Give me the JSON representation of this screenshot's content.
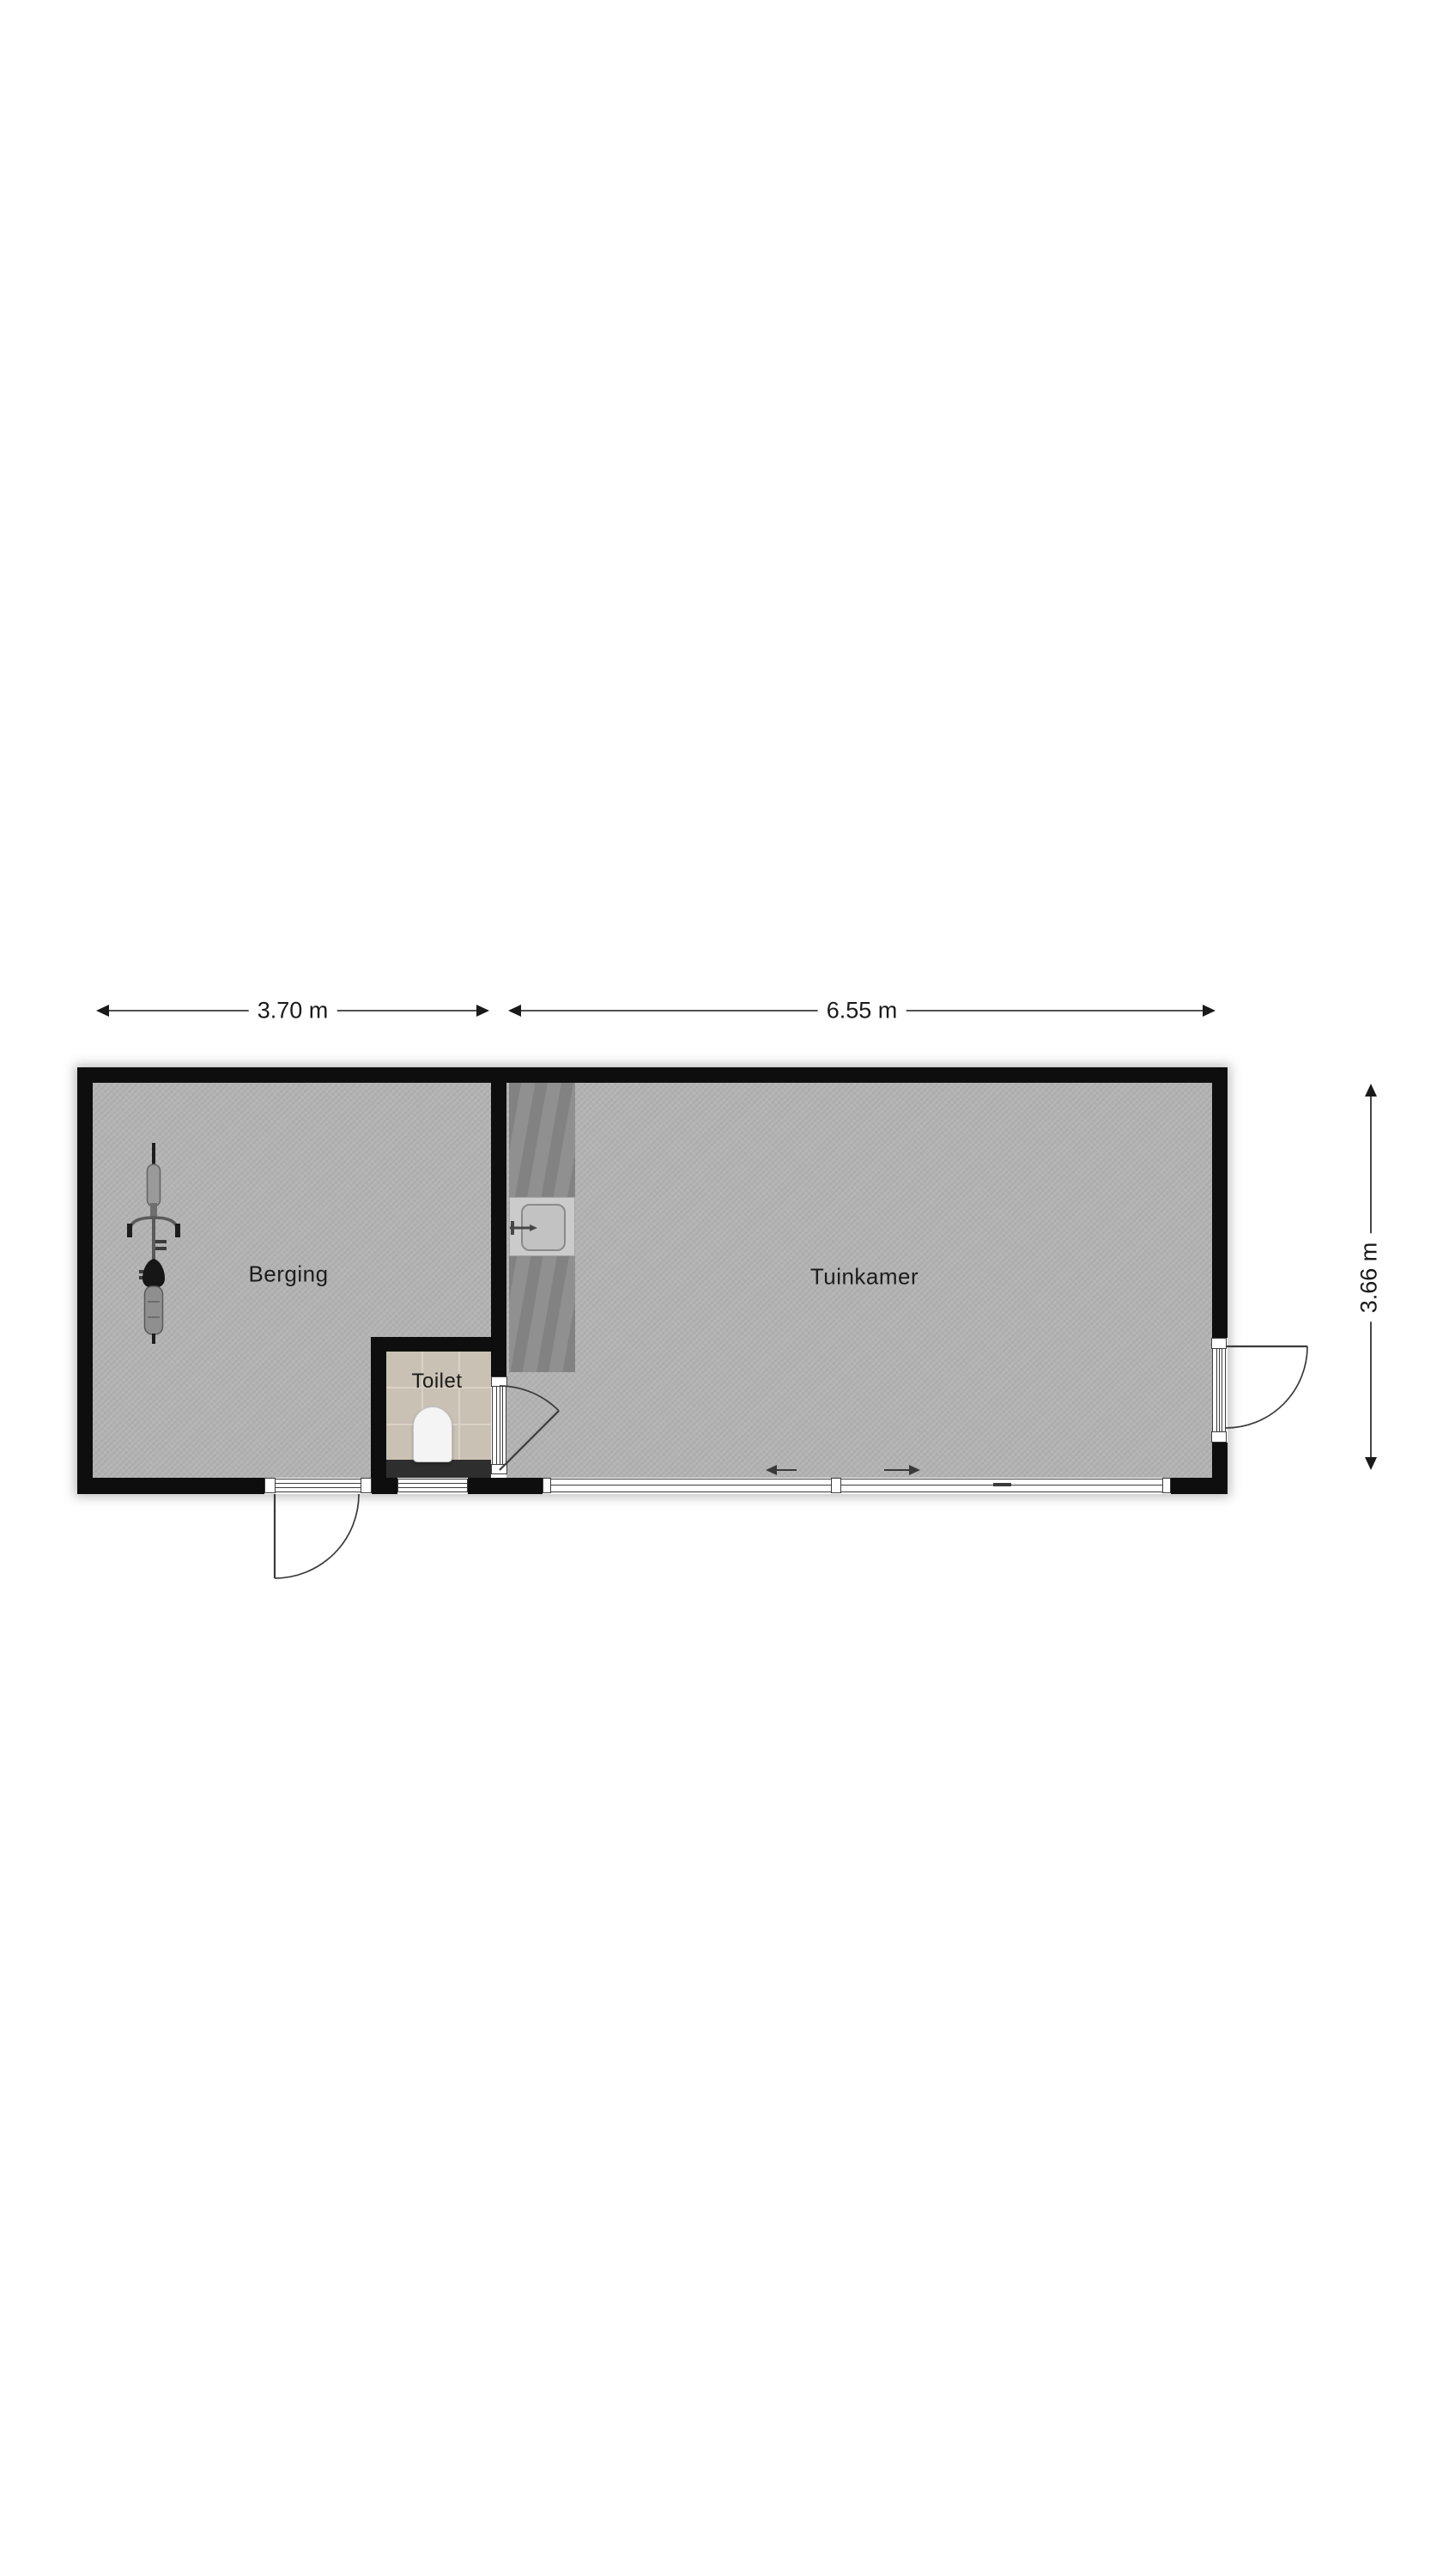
{
  "floorplan": {
    "type": "floor-plan",
    "rooms": [
      {
        "name": "Berging"
      },
      {
        "name": "Tuinkamer"
      },
      {
        "name": "Toilet"
      }
    ],
    "dimensions": {
      "berging_width": "3.70 m",
      "tuinkamer_width": "6.55 m",
      "depth": "3.66 m"
    },
    "fixtures": [
      {
        "icon": "bicycle-icon",
        "room": "Berging"
      },
      {
        "icon": "kitchen-counter",
        "room": "Tuinkamer"
      },
      {
        "icon": "kitchen-sink-icon",
        "room": "Tuinkamer"
      },
      {
        "icon": "faucet-icon",
        "room": "Tuinkamer"
      },
      {
        "icon": "toilet-fixture-icon",
        "room": "Toilet"
      },
      {
        "icon": "door-swing-icon",
        "count": 3
      },
      {
        "icon": "window-icon",
        "count": 2
      },
      {
        "icon": "sliding-door-arrows-icon",
        "room": "Tuinkamer"
      }
    ],
    "colors": {
      "bg": "#ffffff",
      "wall": "#0e0e0e",
      "floor": "#b3b3b3",
      "floor-toilet": "#c9c1b3",
      "grout": "#d9d3c7",
      "counter": "#8a8a8a",
      "counter-sink": "#cbcbcb",
      "cistern": "#2e2e2e",
      "line": "#3a3a3a",
      "frame-line": "#3c3c3c",
      "dim": "#1a1a1a"
    }
  }
}
